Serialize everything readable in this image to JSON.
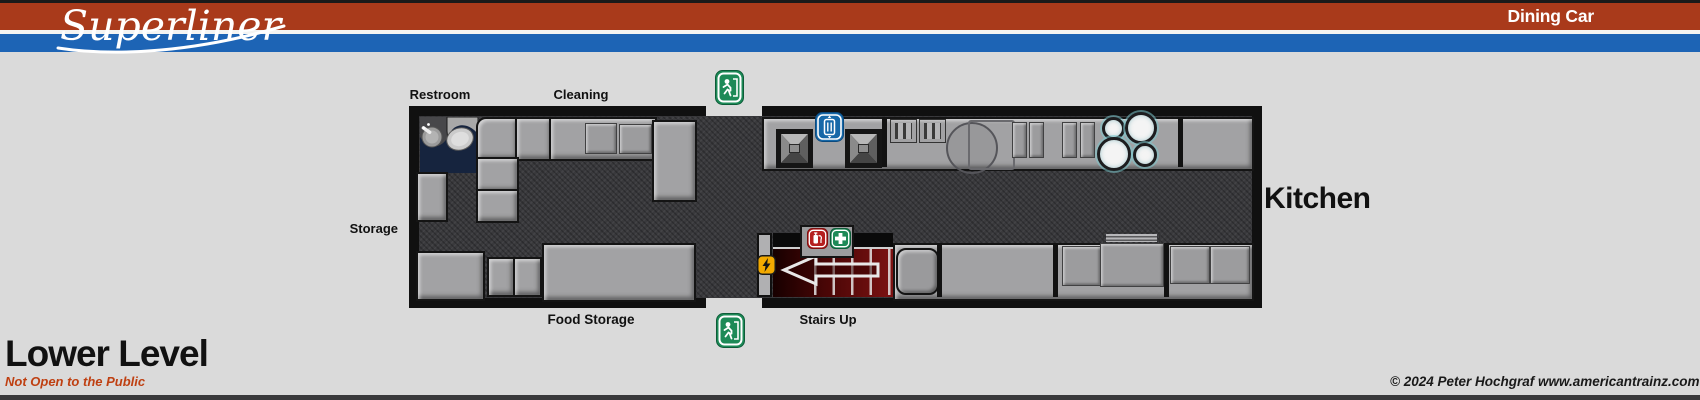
{
  "header": {
    "brand": "Superliner",
    "car_label": "Dining Car",
    "colors": {
      "bar_red": "#a93a1b",
      "bar_blue": "#1d64b5"
    }
  },
  "plan": {
    "labels": {
      "restroom": "Restroom",
      "cleaning": "Cleaning",
      "storage": "Storage",
      "food_storage": "Food Storage",
      "stairs_up": "Stairs Up",
      "kitchen": "Kitchen"
    },
    "icons": {
      "exit_top": "exit-sign",
      "exit_bottom": "exit-sign",
      "dumbwaiter_sign": "dumbwaiter-lift-sign",
      "fire_extinguisher": "fire-extinguisher-sign",
      "first_aid": "first-aid-sign",
      "electrical_hazard": "electrical-hazard-sign"
    },
    "colors": {
      "floor": "#39393c",
      "counter": "#a2a2a4",
      "restroom_floor": "#16243e",
      "stairs_red": "#6e0f0f",
      "exit_green": "#1d8a57",
      "lift_blue": "#1668a8",
      "extinguisher_red": "#b51f1f",
      "hazard_yellow": "#f2a900"
    }
  },
  "footer": {
    "level_title": "Lower Level",
    "restriction_note": "Not Open to the Public",
    "note_color": "#bf4012",
    "copyright": "© 2024 Peter Hochgraf www.americantrainz.com"
  }
}
